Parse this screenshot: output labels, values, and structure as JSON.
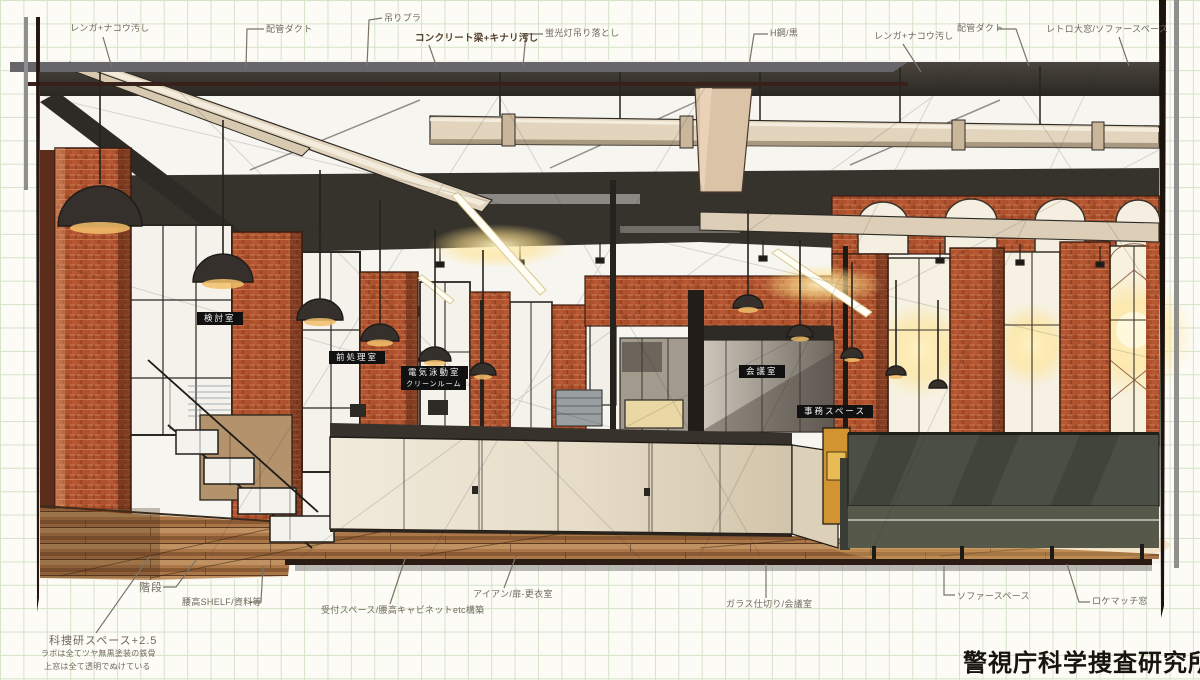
{
  "title": {
    "text": "警視庁科学捜査研究所"
  },
  "room_labels": [
    {
      "text": "検討室"
    },
    {
      "text": "前処理室"
    },
    {
      "text": "電気泳動室"
    },
    {
      "text": "クリーンルーム"
    },
    {
      "text": "会議室"
    },
    {
      "text": "事務スペース"
    }
  ],
  "annotations": [
    {
      "text": "レンガ+ナコウ汚し"
    },
    {
      "text": "配管ダクト"
    },
    {
      "text": "吊りプラ"
    },
    {
      "text": "コンクリート梁+キナリ汚し"
    },
    {
      "text": "蛍光灯吊り落とし"
    },
    {
      "text": "H鋼/黒"
    },
    {
      "text": "レンガ+ナコウ汚し"
    },
    {
      "text": "配管ダクト"
    },
    {
      "text": "レトロ大窓/ソファースペース"
    },
    {
      "text": "階段"
    },
    {
      "text": "腰高SHELF/資料等"
    },
    {
      "text": "受付スペース/腰高キャビネットetc構築"
    },
    {
      "text": "アイアン/扉-更衣室"
    },
    {
      "text": "ガラス仕切り/会議室"
    },
    {
      "text": "ソファースペース"
    },
    {
      "text": "ロケマッチ窓"
    },
    {
      "text": "科捜研スペース+2.5"
    },
    {
      "text": "ラボは全てツヤ無黒塗装の鉄骨"
    },
    {
      "text": "上窓は全て透明でぬけている"
    }
  ],
  "colors": {
    "paper": "#f7f5ef",
    "grid_line": "#d5e3c9",
    "brick": "#b0512d",
    "duct_cream": "#e2d4bd",
    "ceiling_dark": "#35312c",
    "counter_cream": "#ece4d4",
    "sofa_green_gray": "#4b4e44",
    "cabinet_orange": "#d29430",
    "label_bg": "#111111",
    "ink": "#6f6a5e"
  }
}
